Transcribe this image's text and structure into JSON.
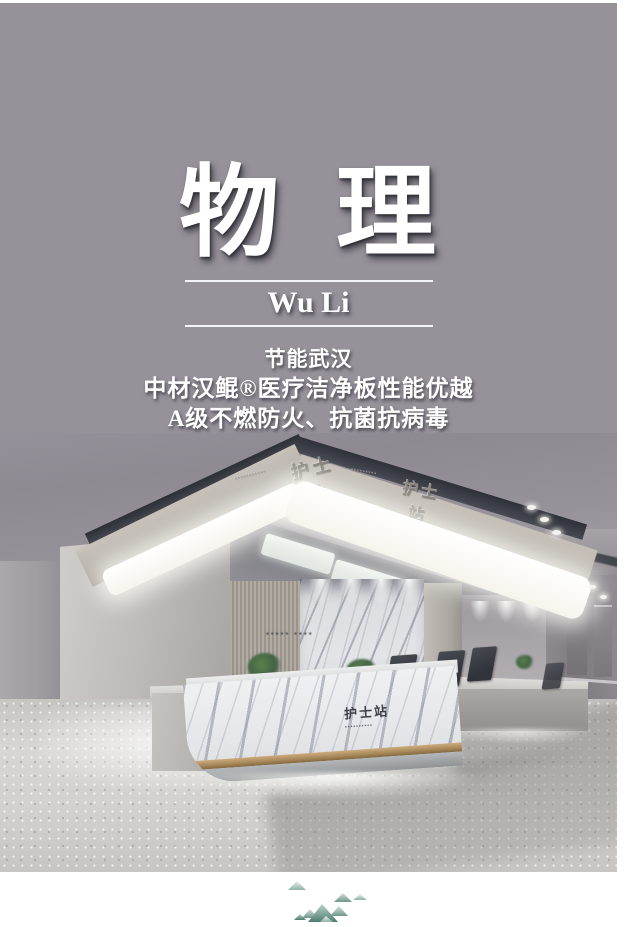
{
  "poster": {
    "title": "物 理",
    "romanized": "Wu Li",
    "tagline": [
      "节能武汉",
      "中材汉鲲®医疗洁净板性能优越",
      "A级不燃防火、抗菌抗病毒"
    ],
    "background_color": "#97919a",
    "text_color": "#ffffff"
  },
  "photo": {
    "description": "hospital nurse station reception interior",
    "soffit_sign_left": {
      "label": "护士站",
      "caption": "▪▪▪▪▪▪▪▪▪▪▪"
    },
    "soffit_sign_right": {
      "label": "护士站",
      "caption": "▪▪▪▪▪▪▪▪▪"
    },
    "wall_slogan": "▪▪▪▪▪  ▪▪▪▪",
    "counter_sign": {
      "label": "护士站",
      "caption": "▪▪▪▪▪▪▪▪▪▪"
    },
    "accent_colors": {
      "led_white": "#fdfdf6",
      "gold_trim": "#a98a5c",
      "soffit_dark": "#2e3138"
    }
  },
  "footer": {
    "illustration": "watercolor-mountains",
    "mountain_teal": "#5f8a7e"
  }
}
